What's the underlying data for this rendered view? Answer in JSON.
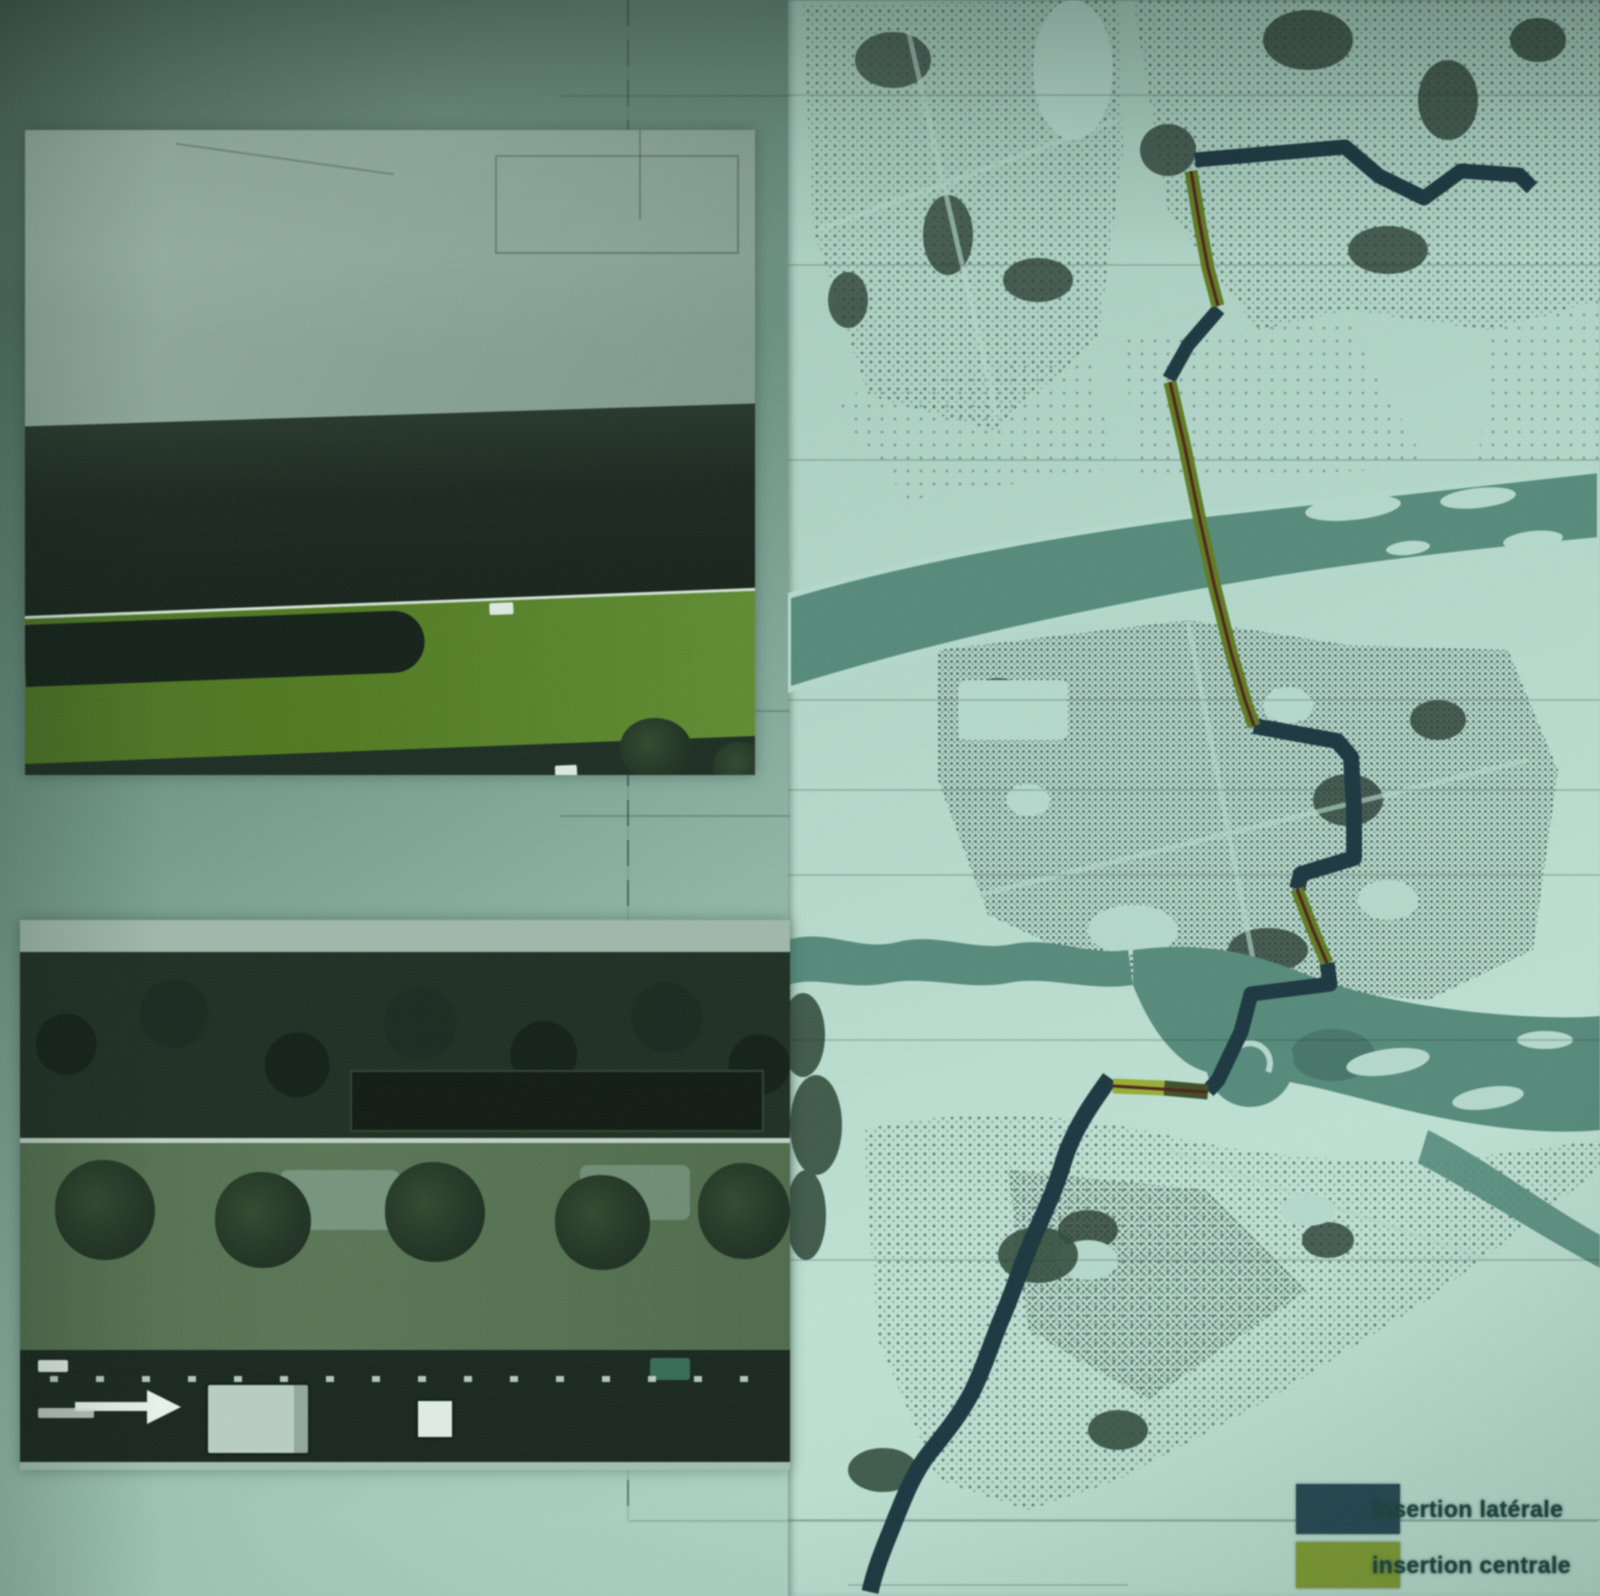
{
  "legend": {
    "items": [
      {
        "name": "insertion-laterale",
        "label": "insertion latérale",
        "color": "#1e4650"
      },
      {
        "name": "insertion-centrale",
        "label": "insertion centrale",
        "color": "#7a9b26"
      }
    ]
  },
  "palette": {
    "route_lateral_navy": "#16343e",
    "route_central_olive": "#5c7a19",
    "route_central_bright": "#94ae29",
    "route_axis_red": "#4f1d13",
    "river_teal": "#4f8a79",
    "map_paper_mint": "#b2dacc",
    "city_fabric_speckle": "#36504a",
    "tram_corridor_green": "#4d7a16"
  }
}
